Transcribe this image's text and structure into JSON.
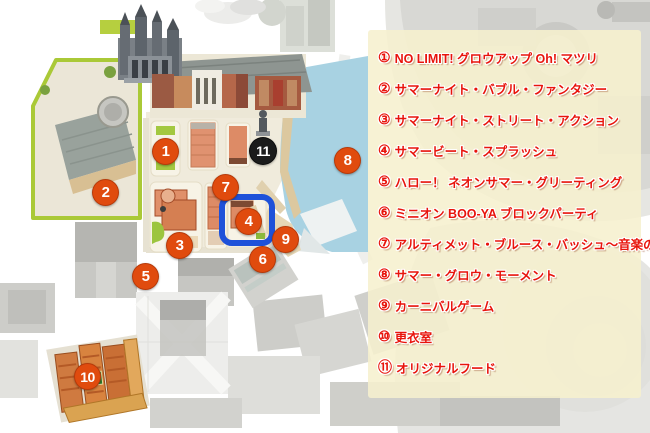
{
  "map": {
    "markers": [
      {
        "label": "1",
        "variant": "orange"
      },
      {
        "label": "2",
        "variant": "orange"
      },
      {
        "label": "3",
        "variant": "orange"
      },
      {
        "label": "4",
        "variant": "orange",
        "highlighted": true
      },
      {
        "label": "5",
        "variant": "orange"
      },
      {
        "label": "6",
        "variant": "orange"
      },
      {
        "label": "7",
        "variant": "orange"
      },
      {
        "label": "8",
        "variant": "orange"
      },
      {
        "label": "9",
        "variant": "orange"
      },
      {
        "label": "10",
        "variant": "orange"
      },
      {
        "label": "11",
        "variant": "black"
      }
    ],
    "highlighted_marker": "4",
    "colors": {
      "marker_orange": "#e04b0e",
      "marker_black": "#1b1b1b",
      "highlight_blue": "#1e51d9",
      "water_blue": "#a8d2e2",
      "area_outline_green": "#aac937",
      "legend_background": "#f6f0ce",
      "legend_text_red": "#e8140c"
    }
  },
  "legend": {
    "items": [
      {
        "num": "①",
        "label": "NO LIMIT! グロウアップ Oh! マツリ"
      },
      {
        "num": "②",
        "label": "サマーナイト・バブル・ファンタジー"
      },
      {
        "num": "③",
        "label": "サマーナイト・ストリート・アクション"
      },
      {
        "num": "④",
        "label": "サマービート・スプラッシュ"
      },
      {
        "num": "⑤",
        "label": "ハロー！ ネオンサマー・グリーティング"
      },
      {
        "num": "⑥",
        "label": "ミニオン BOO-YA ブロックパーティ"
      },
      {
        "num": "⑦",
        "label": "アルティメット・ブルース・バッシュ～音楽の色～"
      },
      {
        "num": "⑧",
        "label": "サマー・グロウ・モーメント"
      },
      {
        "num": "⑨",
        "label": "カーニバルゲーム"
      },
      {
        "num": "⑩",
        "label": "更衣室"
      },
      {
        "num": "⑪",
        "label": "オリジナルフード"
      }
    ]
  }
}
